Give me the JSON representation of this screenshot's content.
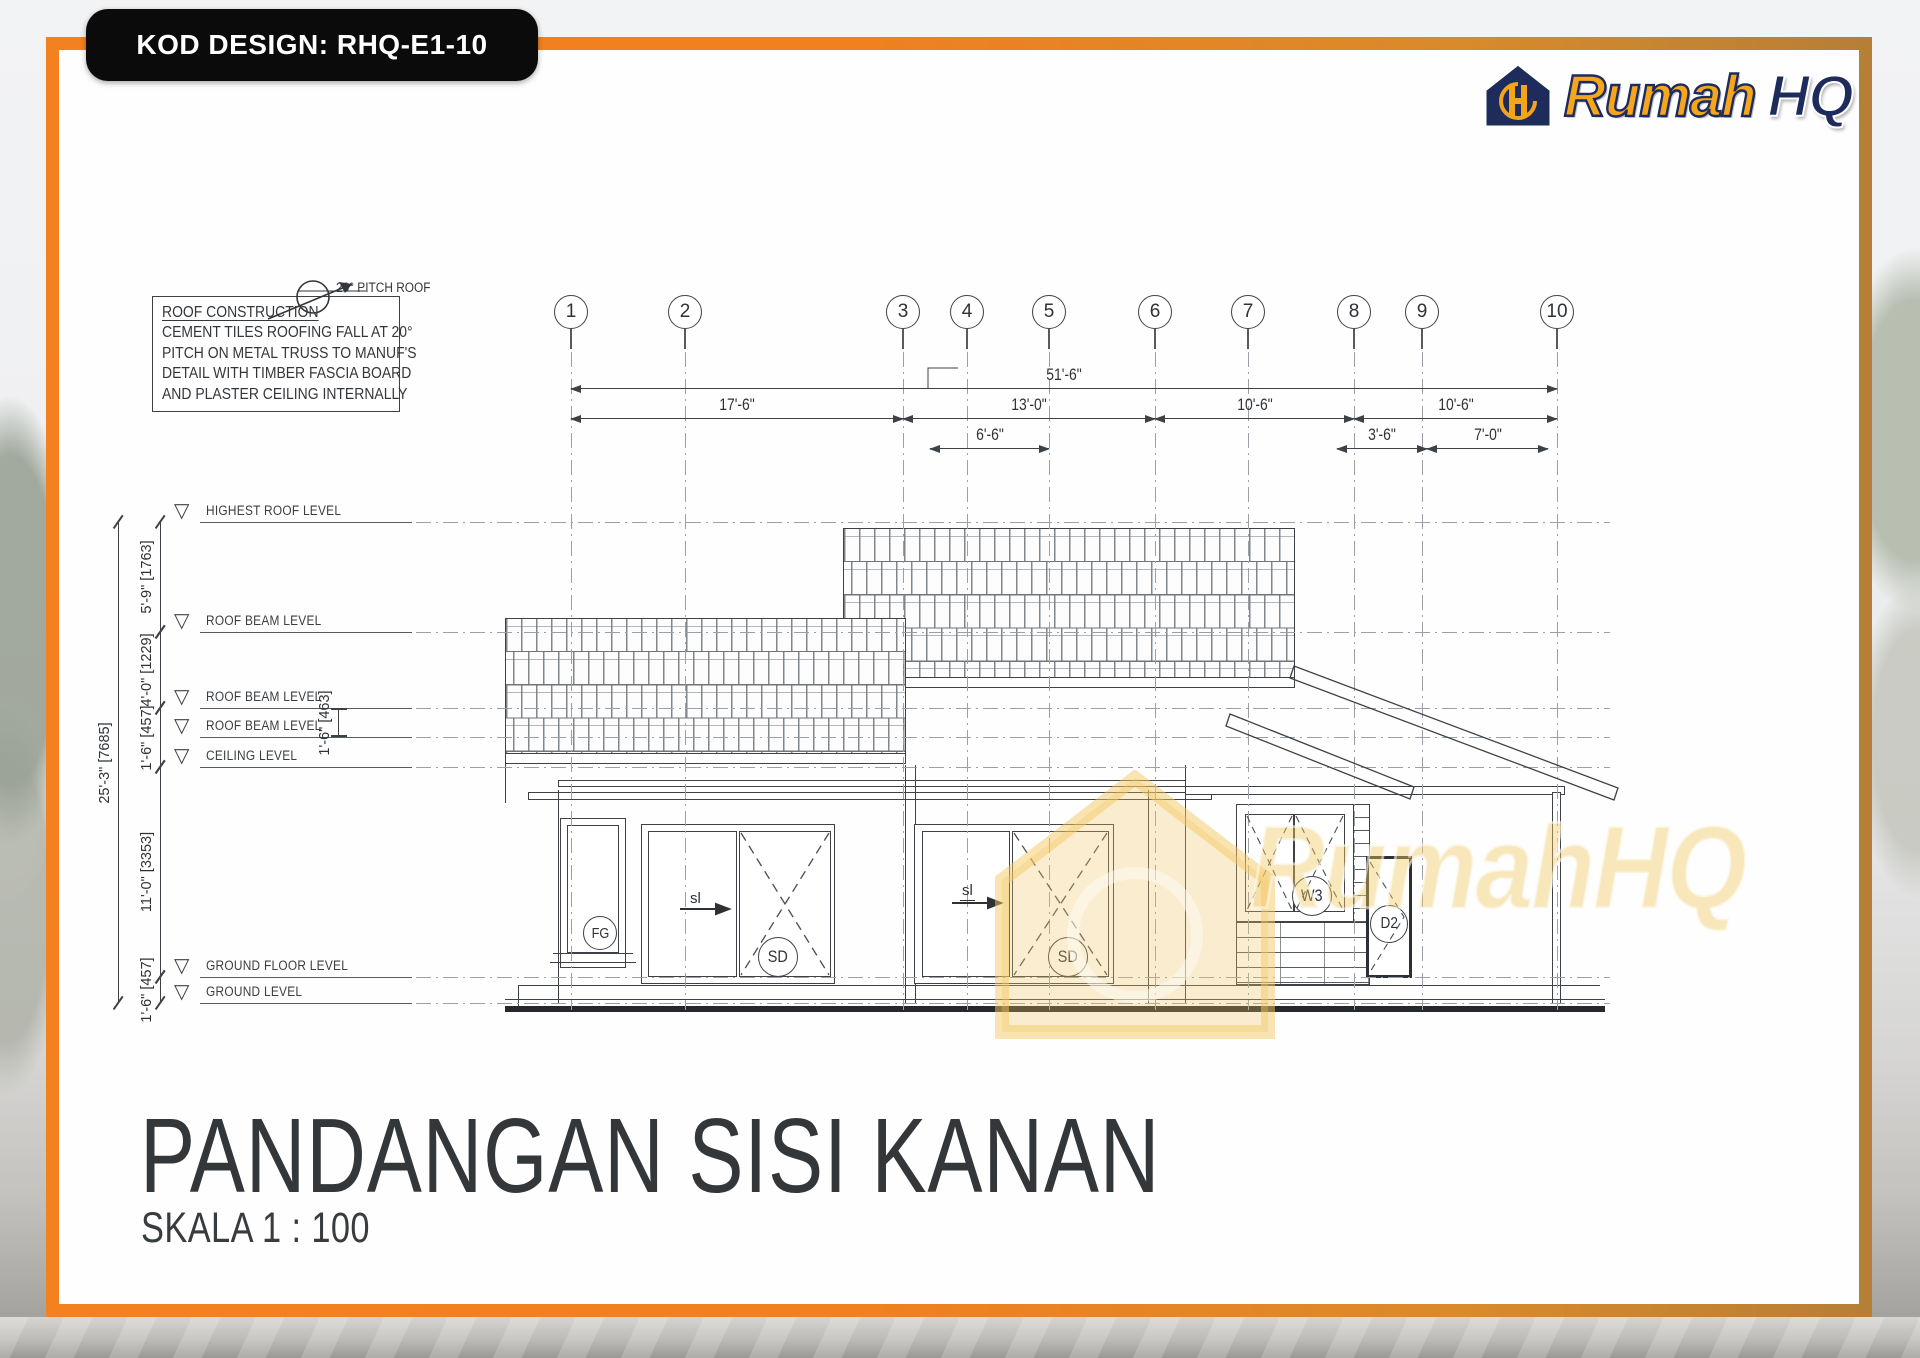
{
  "frame": {
    "kod_label": "KOD DESIGN: RHQ-E1-10"
  },
  "logo": {
    "brand_primary": "Rumah",
    "brand_secondary": "HQ"
  },
  "watermark": {
    "text": "RumahHQ"
  },
  "note": {
    "title": "ROOF CONSTRUCTION",
    "lines": [
      "CEMENT TILES ROOFING FALL AT 20°",
      "PITCH ON METAL TRUSS TO MANUF'S",
      "DETAIL WITH TIMBER FASCIA BOARD",
      "AND PLASTER CEILING INTERNALLY"
    ]
  },
  "pitch": {
    "label": "20° PITCH ROOF"
  },
  "title_block": {
    "title": "PANDANGAN SISI KANAN",
    "scale": "SKALA 1 : 100"
  },
  "grid_bubbles": [
    {
      "n": "1",
      "x": 571
    },
    {
      "n": "2",
      "x": 685
    },
    {
      "n": "3",
      "x": 903
    },
    {
      "n": "4",
      "x": 967
    },
    {
      "n": "5",
      "x": 1049
    },
    {
      "n": "6",
      "x": 1155
    },
    {
      "n": "7",
      "x": 1248
    },
    {
      "n": "8",
      "x": 1354
    },
    {
      "n": "9",
      "x": 1422
    },
    {
      "n": "10",
      "x": 1557
    }
  ],
  "h_dimensions": [
    {
      "label": "51'-6\"",
      "x1": 571,
      "x2": 1557,
      "y": 388
    },
    {
      "label": "17'-6\"",
      "x1": 571,
      "x2": 903,
      "y": 418
    },
    {
      "label": "13'-0\"",
      "x1": 903,
      "x2": 1155,
      "y": 418
    },
    {
      "label": "10'-6\"",
      "x1": 1155,
      "x2": 1354,
      "y": 418
    },
    {
      "label": "10'-6\"",
      "x1": 1354,
      "x2": 1557,
      "y": 418
    },
    {
      "label": "6'-6\"",
      "x1": 930,
      "x2": 1049,
      "y": 448
    },
    {
      "label": "3'-6\"",
      "x1": 1337,
      "x2": 1427,
      "y": 448
    },
    {
      "label": "7'-0\"",
      "x1": 1427,
      "x2": 1548,
      "y": 448
    }
  ],
  "v_dimensions": [
    {
      "label": "25'-3\" [7685]",
      "x": 118,
      "y1": 522,
      "y2": 1003
    },
    {
      "label": "5'-9\" [1763]",
      "x": 160,
      "y1": 522,
      "y2": 632
    },
    {
      "label": "4'-0\" [1229]",
      "x": 160,
      "y1": 632,
      "y2": 708
    },
    {
      "label": "1'-6\" [457]",
      "x": 160,
      "y1": 708,
      "y2": 767
    },
    {
      "label": "11'-0\" [3353]",
      "x": 160,
      "y1": 767,
      "y2": 977
    },
    {
      "label": "1'-6\" [457]",
      "x": 160,
      "y1": 977,
      "y2": 1003
    },
    {
      "label": "1'-6\" [463]",
      "x": 338,
      "y1": 708,
      "y2": 737,
      "bracket": true
    }
  ],
  "levels": [
    {
      "label": "HIGHEST ROOF LEVEL",
      "y": 522
    },
    {
      "label": "ROOF BEAM LEVEL",
      "y": 632
    },
    {
      "label": "ROOF BEAM LEVEL",
      "y": 708
    },
    {
      "label": "ROOF BEAM LEVEL",
      "y": 737
    },
    {
      "label": "CEILING LEVEL",
      "y": 767
    },
    {
      "label": "GROUND FLOOR LEVEL",
      "y": 977
    },
    {
      "label": "GROUND LEVEL",
      "y": 1003
    }
  ],
  "tags": {
    "fg": "FG",
    "sd": "SD",
    "sl": "sl",
    "w3": "W3",
    "d2": "D2"
  },
  "colors": {
    "accent_orange": "#f08020",
    "brand_navy": "#1e2c5c",
    "brand_yellow": "#f5a61c"
  }
}
